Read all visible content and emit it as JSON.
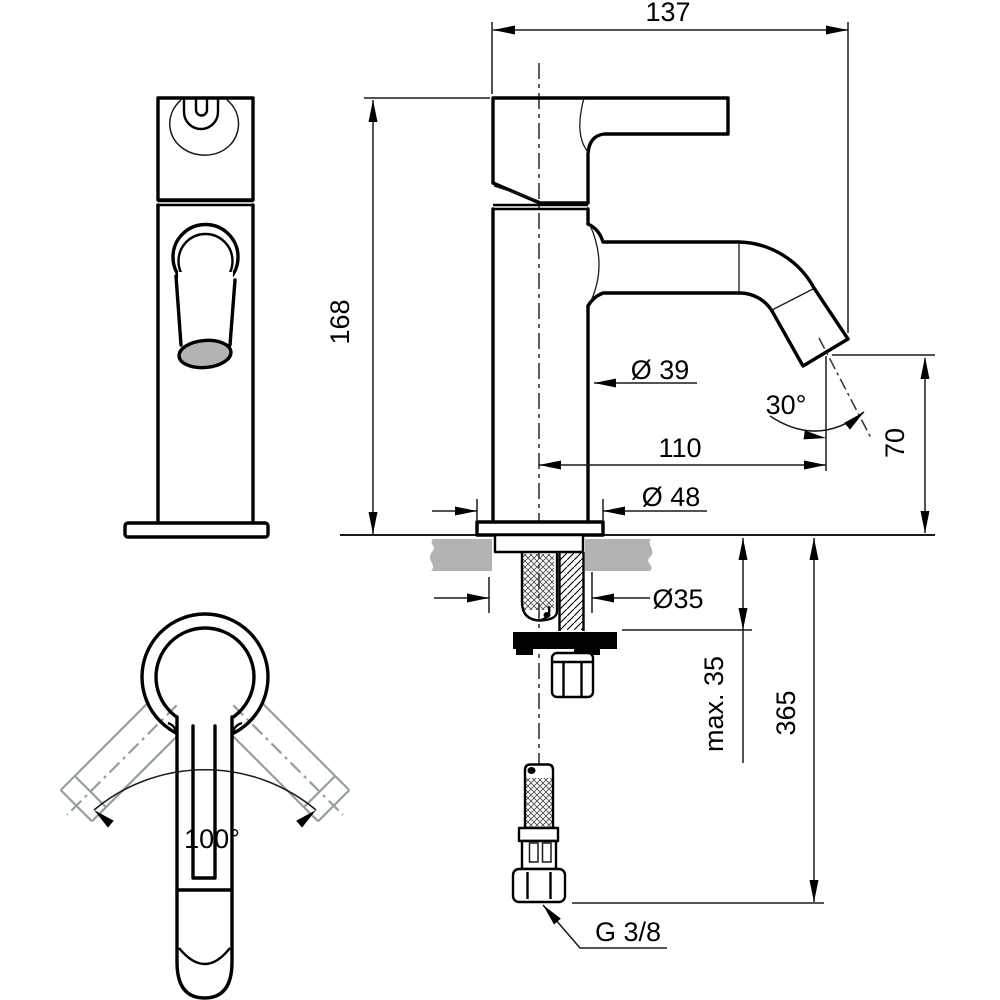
{
  "drawing": {
    "type": "technical-dimension-drawing",
    "subject": "single-lever basin mixer faucet with mounting hardware and supply hose",
    "labels": {
      "overall_width": "137",
      "overall_height": "168",
      "body_diameter": "Ø 39",
      "spout_angle": "30°",
      "spout_reach": "110",
      "spout_outlet_height": "70",
      "base_diameter": "Ø 48",
      "mounting_hole_diameter": "Ø35",
      "max_deck_thickness": "max. 35",
      "hose_length": "365",
      "connection_thread": "G 3/8",
      "handle_swivel_angle": "100°"
    },
    "colors": {
      "line": "#000000",
      "dimension_line": "#1a1a1a",
      "counter_fill": "#b3b3b3",
      "spout_outlet_fill": "#b3b3b3",
      "phantom_gray": "#93a0a0",
      "washer_fill": "#000000",
      "background": "#ffffff"
    }
  }
}
